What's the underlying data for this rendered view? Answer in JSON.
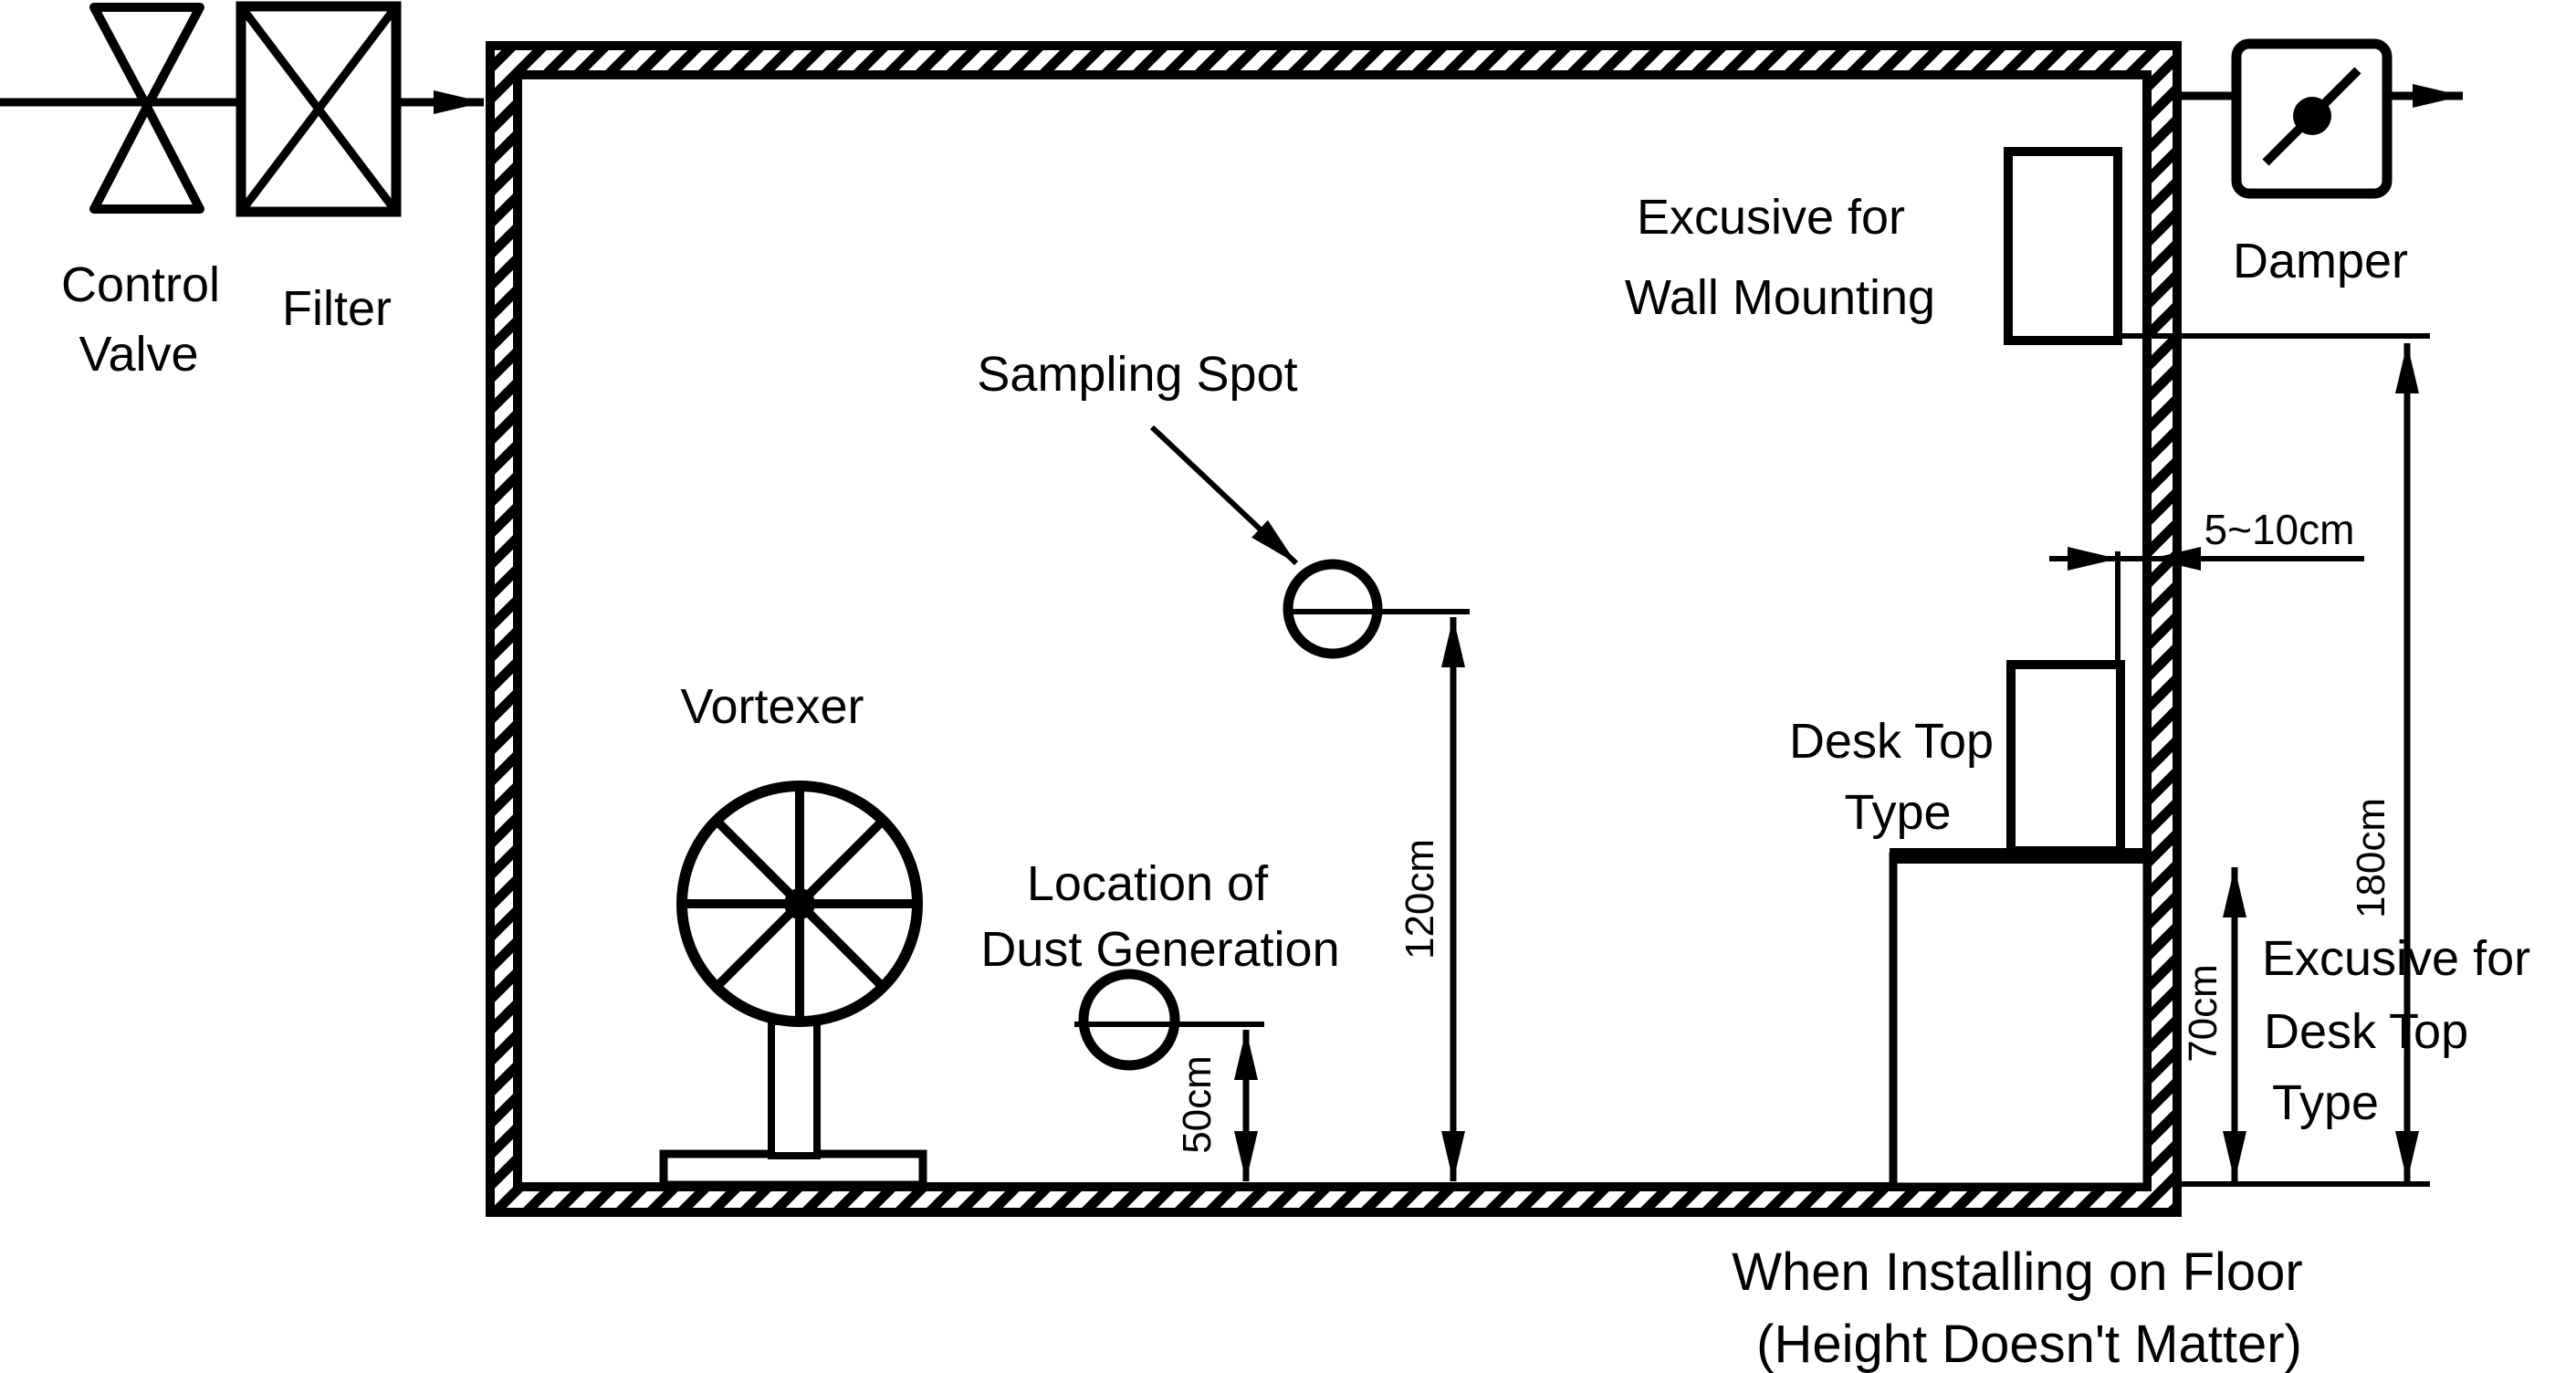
{
  "labels": {
    "control_line1": "Control",
    "control_line2": "Valve",
    "filter": "Filter",
    "sampling_spot": "Sampling Spot",
    "vortexer": "Vortexer",
    "dust_line1": "Location of",
    "dust_line2": "Dust Generation",
    "wall_mount_line1": "Excusive for",
    "wall_mount_line2": "Wall Mounting",
    "damper": "Damper",
    "desk_top_line1": "Desk Top",
    "desk_top_line2": "Type",
    "desk_excusive_line1": "Excusive for",
    "desk_excusive_line2": "Desk Top",
    "desk_excusive_line3": "Type",
    "footer_line1": "When Installing on Floor",
    "footer_line2": "(Height Doesn't Matter)"
  },
  "dimensions": {
    "sampling_height": "120cm",
    "dust_height": "50cm",
    "desk_height": "70cm",
    "total_height": "180cm",
    "wall_gap": "5~10cm"
  },
  "colors": {
    "ink": "#000000",
    "background": "#ffffff"
  }
}
